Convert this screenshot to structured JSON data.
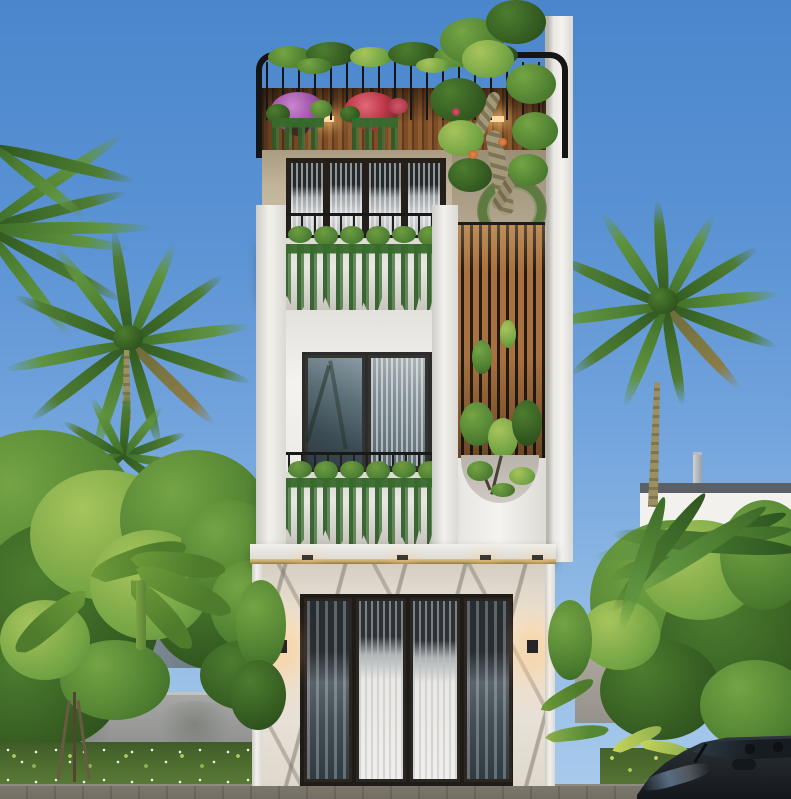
{
  "scene": {
    "type": "architectural-exterior-render",
    "aria": {
      "stage": "3D exterior render of a narrow three-storey modern tube house among tropical trees",
      "sky": "clear blue sky",
      "house": "three-storey white townhouse street facade",
      "roof_terrace": "rooftop terrace with black steel pergola frame, wood slat ceiling, hanging flower baskets and a sculpted frangipani tree",
      "third_floor": "third floor balcony with four-panel glass doors, black railing and concrete planter with trailing vines",
      "second_floor": "second floor balcony with double french doors, black railing and concrete planter with trailing vines",
      "timber_screen": "vertical timber louvre screen with climbing plants and circular green wreath",
      "arch_cutout": "semicircular wall cutout revealing a courtyard tree",
      "ground_floor": "marble clad ground floor with four-panel black framed glass sliding door and wall sconces",
      "left_trees": "palm trees and dense tropical foliage on the left",
      "right_palm": "tall palm tree on the right",
      "neighbor_left": "neighbouring grey house with curved roof behind trees",
      "neighbor_right": "neighbouring white flat-roof house with vent pipe",
      "fence_left": "grey boundary wall on the left",
      "fence_right": "grey boundary wall on the right",
      "garden": "street garden bed with white daisies and young staked tree",
      "car": "dark grey sedan parked at the kerb",
      "pavement": "paved concrete sidewalk"
    },
    "palette": {
      "sky_top": "#4b86cc",
      "sky_bottom": "#a9cbec",
      "frame_black": "#151515",
      "wood_ceiling": "#7c4d26",
      "timber_slat": "#a8713f",
      "beige_wall": "#b9ac93",
      "white_wall": "#f2f1ed",
      "marble": "#e9e3d8",
      "gold_trim": "#bfa05e",
      "foliage_dark": "#32571f",
      "foliage_mid": "#4c7d2f",
      "foliage_light": "#74a444",
      "flower_purple": "#a85cb0",
      "flower_red": "#c0394a",
      "fence_grey": "#9b9c9a",
      "pavement_grey": "#b0aca4",
      "car_body": "#262c31"
    }
  }
}
